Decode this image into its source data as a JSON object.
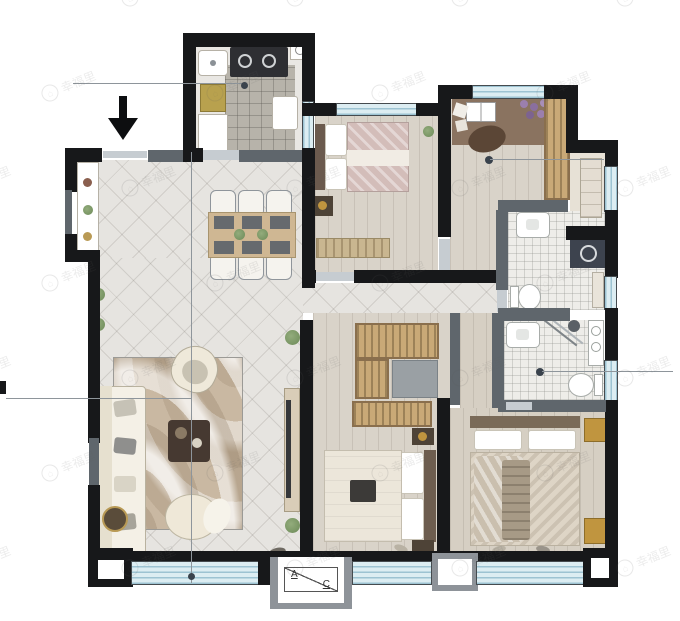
{
  "ac_platform": {
    "label_a": "A",
    "label_c": "C"
  },
  "watermark": {
    "text": "幸福里",
    "icon": "house-circle-icon"
  },
  "colors": {
    "wall": "#17181a",
    "wall_gray": "#5f666c",
    "door_opening": "#c6ccd1",
    "window_fill": "#dcedf2",
    "window_stripe": "#9dc3d2",
    "tile_floor": "#e6e4e0",
    "wood_floor": "#d9d3c9",
    "wood_floor_warm": "#d6cfc3",
    "bath_floor": "#eeede9",
    "kitchen_tile": "#b7b3aa",
    "wardrobe": "#c9a977",
    "accent_gold": "#c0953f",
    "rug": "#c9b8a2",
    "sofa_cream": "#f4f0e6",
    "annotation_line": "#8e959b",
    "annotation_dot": "#39424c",
    "plant_green": "#7f9b6d"
  },
  "rooms": [
    "entry-foyer",
    "kitchen",
    "dining-area",
    "living-room",
    "bedroom-top-middle",
    "study-bedroom-top-right",
    "common-bathroom",
    "master-bathroom",
    "bedroom-bottom-middle",
    "master-bedroom",
    "hallway"
  ],
  "fixtures": [
    "entrance-arrow",
    "dining-table-six-chairs",
    "sofa",
    "armchair",
    "coffee-table",
    "round-pouf",
    "tv-console",
    "area-rug",
    "double-bed",
    "desk-with-open-book",
    "wardrobe",
    "washing-machine",
    "toilet",
    "sink",
    "corner-shower",
    "console-table",
    "floor-plant",
    "fridge",
    "stove",
    "ac-platform"
  ],
  "annotations": [
    "kitchen-leader-line",
    "study-leader-line",
    "bathroom-leader-line",
    "sofa-leader-line",
    "vertical-reference-line"
  ]
}
